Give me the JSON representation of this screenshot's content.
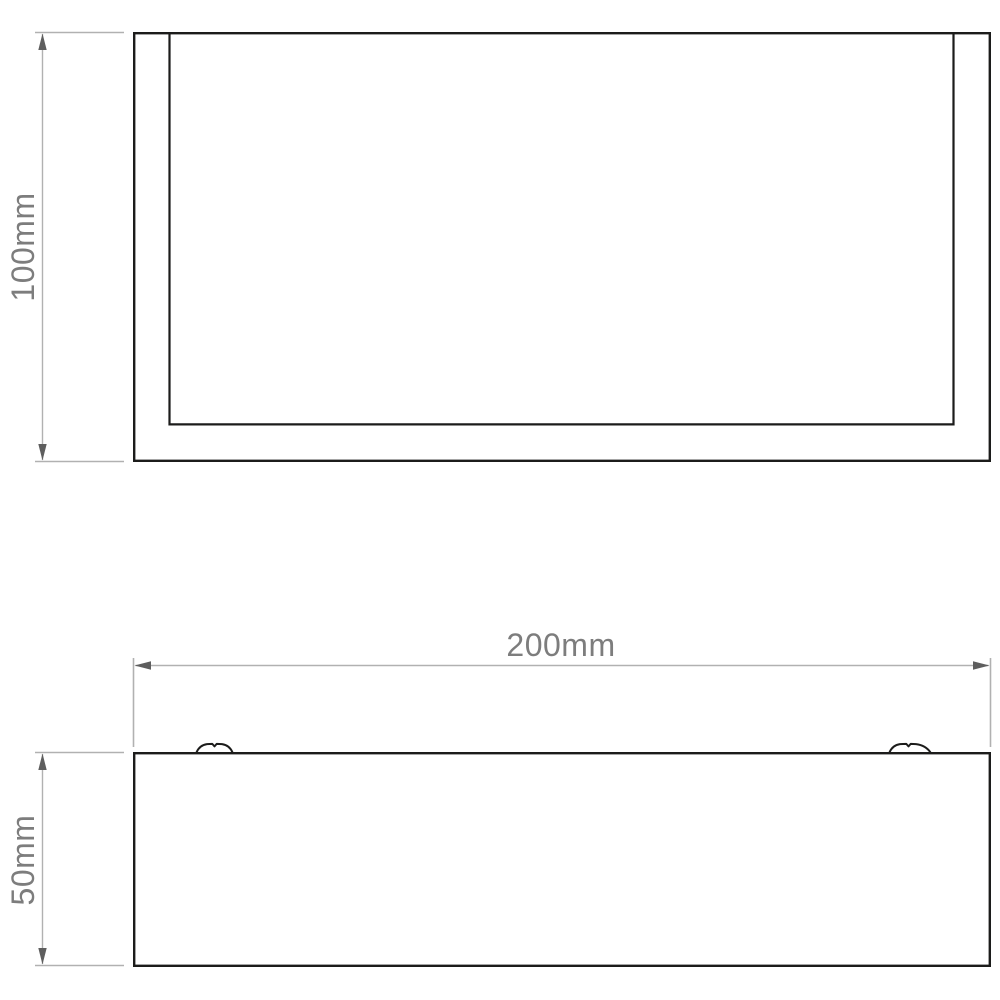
{
  "palette": {
    "background": "#ffffff",
    "outline": "#1c1c1b",
    "dimension_line": "#b1b1b1",
    "arrowhead": "#5e5e5e",
    "label": "#7d7d7d"
  },
  "dimensions": {
    "height": {
      "label": "100mm"
    },
    "width": {
      "label": "200mm"
    },
    "depth": {
      "label": "50mm"
    }
  }
}
